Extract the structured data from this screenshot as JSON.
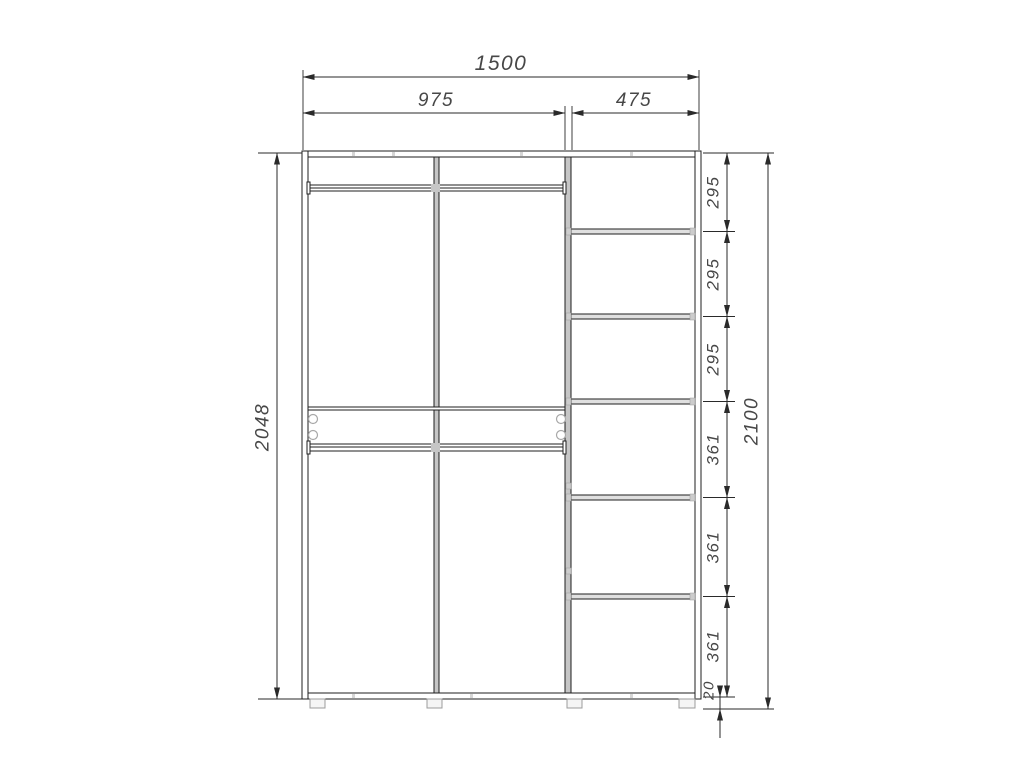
{
  "dimensions": {
    "total_width": "1500",
    "left_section_width": "975",
    "right_section_width": "475",
    "cabinet_height": "2048",
    "total_height": "2100",
    "right_sections": [
      "295",
      "295",
      "295",
      "361",
      "361",
      "361"
    ],
    "base_height": "20"
  },
  "colors": {
    "background": "#ffffff",
    "line": "#1f1f1f",
    "dim_line": "#2a2a2a",
    "dim_text": "#474747",
    "panel_fill": "#c6c6c6",
    "shelf_fill": "#e0e0e0",
    "hardware": "#a8a8a8"
  }
}
